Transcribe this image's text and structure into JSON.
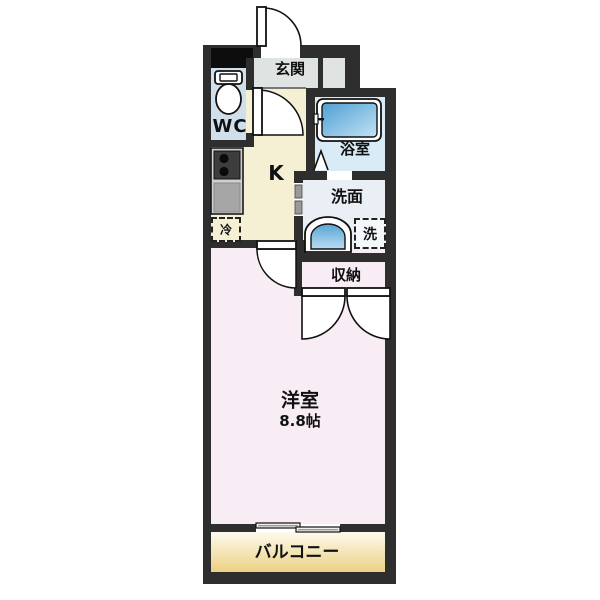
{
  "floorplan": {
    "rooms": {
      "genkan": {
        "label": "玄関"
      },
      "wc": {
        "label": "WC"
      },
      "kitchen": {
        "label": "K"
      },
      "bath": {
        "label": "浴室"
      },
      "washroom": {
        "label": "洗面"
      },
      "laundry": {
        "label": "洗"
      },
      "fridge": {
        "label": "冷"
      },
      "storage": {
        "label": "収納"
      },
      "main_room": {
        "label": "洋室",
        "size": "8.8帖"
      },
      "balcony": {
        "label": "バルコニー"
      }
    },
    "colors": {
      "wall": "#2e2e2e",
      "genkan_floor": "#dfe3e2",
      "wc_floor": "#cfdfeb",
      "kitchen_floor": "#f5efd3",
      "bath_floor": "#d8ebf7",
      "washroom_floor": "#e9eff4",
      "storage_floor": "#f6dfc6",
      "main_room_floor": "#f8edf4",
      "balcony_top": "#fdfaee",
      "balcony_bottom": "#ecd183",
      "fixture_blue": "#5aa5d6"
    }
  }
}
